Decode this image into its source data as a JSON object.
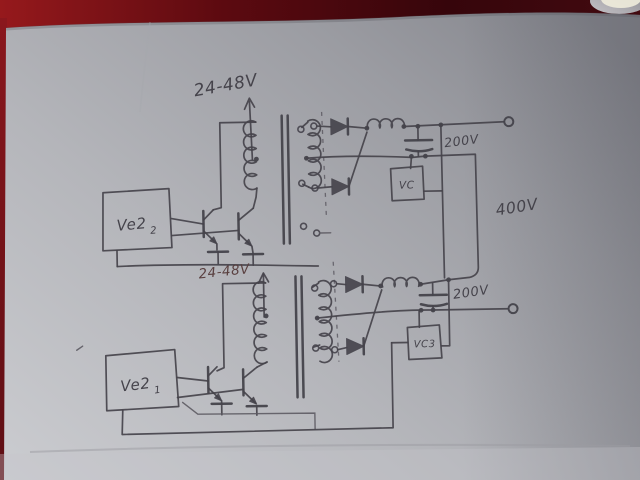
{
  "colors": {
    "bg-top": "#8f191c",
    "bg-deep": "#3c070c",
    "bg-left": "#7c1218",
    "paper-light": "#cbccd0",
    "paper-mid": "#b2b3b8",
    "paper-dark": "#84858c",
    "pencil": "#45434b",
    "pencil-soft": "#5d5b63",
    "ink-red": "#5a4040",
    "blob": "#e0dac4"
  },
  "schematic": {
    "supply_upper": "24-48V",
    "supply_lower": "24-48V",
    "driver_upper": {
      "name": "Ve2",
      "sub": "2"
    },
    "driver_lower": {
      "name": "Ve2",
      "sub": "1"
    },
    "controller_upper": "VC",
    "controller_lower": "VC3",
    "output_upper": "200V",
    "output_lower": "200V",
    "output_total": "400V"
  }
}
